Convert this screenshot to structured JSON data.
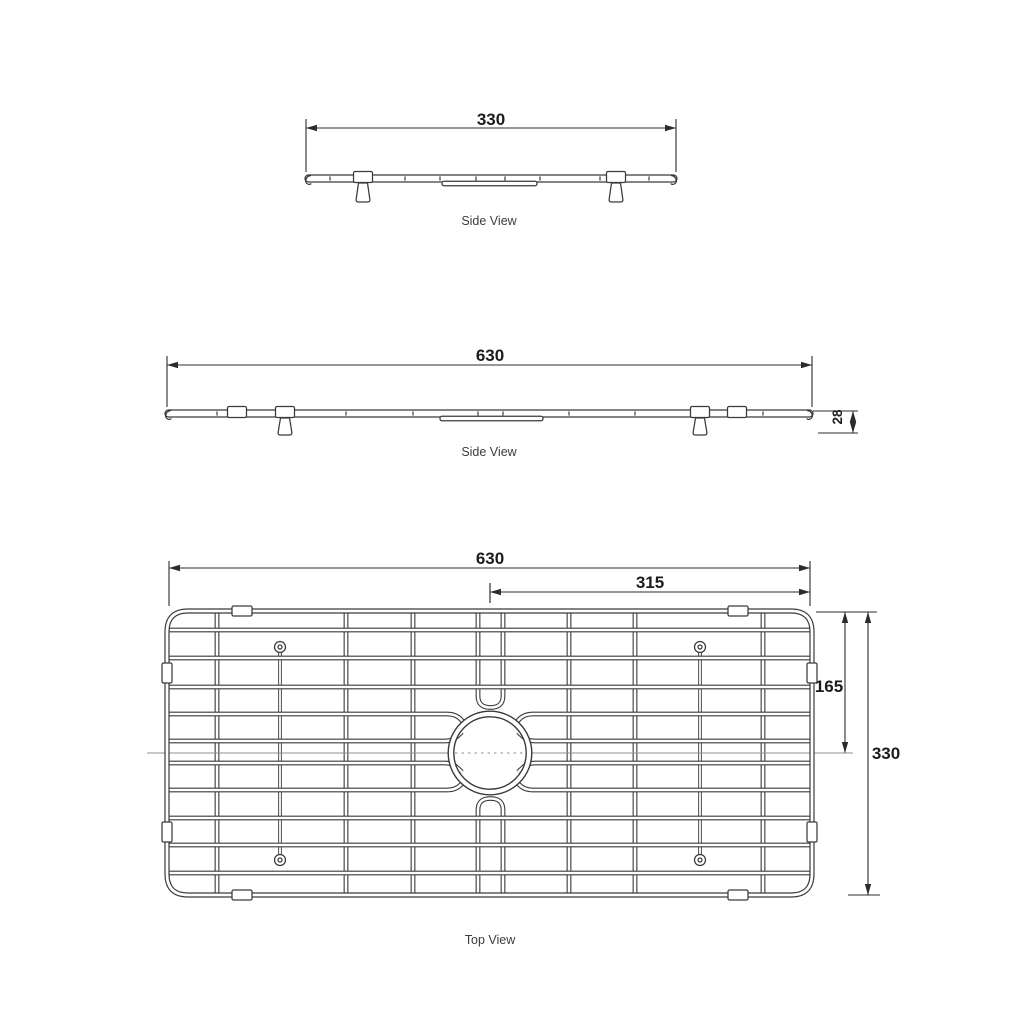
{
  "views": {
    "side330": {
      "dim": "330",
      "caption": "Side View"
    },
    "side630": {
      "dim": "630",
      "height_dim": "28",
      "caption": "Side View"
    },
    "top": {
      "width_dim": "630",
      "half_width_dim": "315",
      "half_height_dim": "165",
      "height_dim": "330",
      "caption": "Top View"
    }
  },
  "colors": {
    "wire": "#3a3a3a",
    "dimension": "#2c2c2c",
    "centerline": "#8f8f8f",
    "text": "#1c1c1c",
    "caption_text": "#3d3d3d",
    "background": "#ffffff"
  },
  "drawing": {
    "side330": {
      "dim": {
        "x1": 306,
        "x2": 676,
        "y": 128,
        "wy1": 119,
        "wy2": 172
      },
      "bar": {
        "x1": 305,
        "x2": 677,
        "y": 175,
        "h": 7
      },
      "ticks": [
        330,
        405,
        440,
        476,
        505,
        540,
        600,
        649
      ],
      "mounts": [
        363,
        616
      ],
      "feet": [
        363,
        616
      ],
      "rail": {
        "x1": 442,
        "x2": 537
      },
      "label_xy": [
        491,
        125
      ],
      "caption_xy": [
        489,
        225
      ]
    },
    "side630": {
      "dim": {
        "x1": 167,
        "x2": 812,
        "y": 365,
        "wy1": 356,
        "wy2": 407
      },
      "bar": {
        "x1": 165,
        "x2": 813,
        "y": 410,
        "h": 7
      },
      "ticks": [
        217,
        346,
        413,
        478,
        503,
        569,
        635,
        763
      ],
      "clips": [
        237,
        737
      ],
      "mounts": [
        285,
        700
      ],
      "feet": [
        285,
        700
      ],
      "rail": {
        "x1": 440,
        "x2": 543
      },
      "hdim": {
        "x": 853,
        "y1": 411,
        "y2": 433,
        "ext_x1": 813,
        "ext_x2": 858,
        "ref_x1": 818,
        "ref_x2": 858,
        "label_xy": [
          842,
          417
        ]
      },
      "label_xy": [
        490,
        361
      ],
      "caption_xy": [
        489,
        456
      ]
    },
    "top": {
      "frame": {
        "x1": 167,
        "y1": 611,
        "x2": 812,
        "y2": 895,
        "r": 21
      },
      "dim_w": {
        "x1": 169,
        "x2": 810,
        "y": 568,
        "wy1": 561,
        "wy2": 606,
        "label_xy": [
          490,
          564
        ]
      },
      "dim_hw": {
        "x1": 490,
        "x2": 810,
        "y": 592,
        "wy1": 583,
        "wy2": 603,
        "label_xy": [
          650,
          588
        ]
      },
      "dim_hh": {
        "x": 845,
        "y1": 612,
        "y2": 753,
        "label_xy": [
          829,
          692
        ]
      },
      "dim_h": {
        "x": 868,
        "y1": 612,
        "y2": 895,
        "label_xy": [
          886,
          759
        ]
      },
      "wit_top": {
        "x1": 816,
        "x2": 877,
        "y": 612
      },
      "wit_bot": {
        "x1": 848,
        "x2": 880,
        "y": 895
      },
      "h_wires_full": [
        630,
        658,
        687,
        818,
        845,
        873
      ],
      "h_wires_split": [
        714,
        741,
        763,
        790
      ],
      "v_wires_full": [
        217,
        346,
        413,
        569,
        635,
        763
      ],
      "v_pair": [
        478,
        503
      ],
      "pins": {
        "xs": [
          280,
          700
        ],
        "y1": 647,
        "y2": 860
      },
      "clips_top_bottom": [
        242,
        738
      ],
      "clips_left_right": [
        673,
        832
      ],
      "ring": {
        "cx": 490,
        "cy": 753,
        "r": 39
      },
      "centerline": {
        "y": 753,
        "x1": 147,
        "x2": 853,
        "dash_x1": 455,
        "dash_x2": 525
      },
      "caption_xy": [
        490,
        944
      ]
    }
  }
}
